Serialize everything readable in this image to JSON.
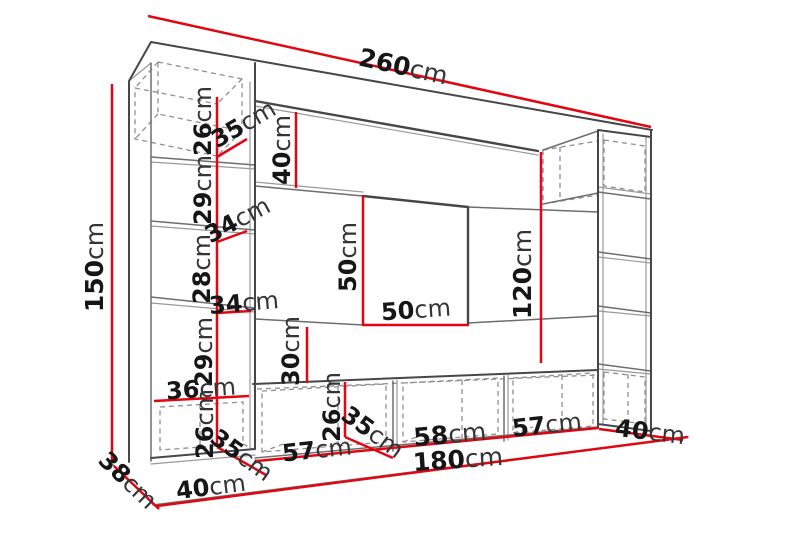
{
  "diagram": {
    "kind": "furniture-wall-unit-dimension-drawing",
    "unit": "cm",
    "colors": {
      "dimension_line": "#e20612",
      "furniture_edge": "#474747",
      "furniture_edge_light": "#9a9a9a",
      "hidden_edge_dash": "#8f8f8f",
      "label_text": "#161616",
      "background": "#ffffff"
    },
    "labels": [
      {
        "id": "total-width",
        "value": "260",
        "unit": "cm",
        "x": 403,
        "y": 68,
        "rot": 12.5,
        "size": 25
      },
      {
        "id": "total-height",
        "value": "150",
        "unit": "cm",
        "x": 96,
        "y": 267,
        "rot": -90,
        "size": 25
      },
      {
        "id": "top-cabinet-height",
        "value": "26",
        "unit": "cm",
        "x": 204,
        "y": 121,
        "rot": -90,
        "size": 24
      },
      {
        "id": "top-cabinet-depth",
        "value": "35",
        "unit": "cm",
        "x": 244,
        "y": 125,
        "rot": -30,
        "size": 24
      },
      {
        "id": "top-panel-height",
        "value": "40",
        "unit": "cm",
        "x": 283,
        "y": 150,
        "rot": -90,
        "size": 24
      },
      {
        "id": "shelf-gap-1",
        "value": "29",
        "unit": "cm",
        "x": 204,
        "y": 190,
        "rot": -90,
        "size": 24
      },
      {
        "id": "shelf-depth-1",
        "value": "34",
        "unit": "cm",
        "x": 238,
        "y": 221,
        "rot": -28,
        "size": 24
      },
      {
        "id": "shelf-gap-2",
        "value": "28",
        "unit": "cm",
        "x": 203,
        "y": 269,
        "rot": -90,
        "size": 24
      },
      {
        "id": "shelf-depth-2",
        "value": "34",
        "unit": "cm",
        "x": 244,
        "y": 304,
        "rot": -5,
        "size": 24
      },
      {
        "id": "shelf-gap-3",
        "value": "29",
        "unit": "cm",
        "x": 205,
        "y": 352,
        "rot": -90,
        "size": 24
      },
      {
        "id": "tv-space-height",
        "value": "50",
        "unit": "cm",
        "x": 349,
        "y": 257,
        "rot": -90,
        "size": 24
      },
      {
        "id": "tv-space-width",
        "value": "50",
        "unit": "cm",
        "x": 416,
        "y": 311,
        "rot": -4,
        "size": 24
      },
      {
        "id": "right-column-height",
        "value": "120",
        "unit": "cm",
        "x": 524,
        "y": 274,
        "rot": -90,
        "size": 25
      },
      {
        "id": "mid-panel-height",
        "value": "30",
        "unit": "cm",
        "x": 292,
        "y": 351,
        "rot": -90,
        "size": 24
      },
      {
        "id": "left-cabinet-width",
        "value": "36",
        "unit": "cm",
        "x": 201,
        "y": 390,
        "rot": -4,
        "size": 24
      },
      {
        "id": "left-cabinet-height",
        "value": "26",
        "unit": "cm",
        "x": 206,
        "y": 424,
        "rot": -90,
        "size": 24
      },
      {
        "id": "left-cabinet-depth",
        "value": "35",
        "unit": "cm",
        "x": 241,
        "y": 456,
        "rot": 36,
        "size": 24
      },
      {
        "id": "bench-1-width",
        "value": "57",
        "unit": "cm",
        "x": 317,
        "y": 451,
        "rot": -6,
        "size": 24
      },
      {
        "id": "bench-height",
        "value": "26",
        "unit": "cm",
        "x": 333,
        "y": 407,
        "rot": -90,
        "size": 24
      },
      {
        "id": "bench-depth",
        "value": "35",
        "unit": "cm",
        "x": 372,
        "y": 433,
        "rot": 36,
        "size": 24
      },
      {
        "id": "bench-2-width",
        "value": "58",
        "unit": "cm",
        "x": 450,
        "y": 436,
        "rot": -5,
        "size": 25
      },
      {
        "id": "benches-total-width",
        "value": "180",
        "unit": "cm",
        "x": 458,
        "y": 461,
        "rot": -4,
        "size": 25
      },
      {
        "id": "bench-3-width",
        "value": "57",
        "unit": "cm",
        "x": 547,
        "y": 426,
        "rot": -6,
        "size": 24
      },
      {
        "id": "right-cabinet-width",
        "value": "40",
        "unit": "cm",
        "x": 650,
        "y": 433,
        "rot": 7,
        "size": 24
      },
      {
        "id": "unit-depth",
        "value": "38",
        "unit": "cm",
        "x": 127,
        "y": 481,
        "rot": 44,
        "size": 24
      },
      {
        "id": "left-column-width",
        "value": "40",
        "unit": "cm",
        "x": 211,
        "y": 488,
        "rot": -7,
        "size": 24
      }
    ]
  }
}
